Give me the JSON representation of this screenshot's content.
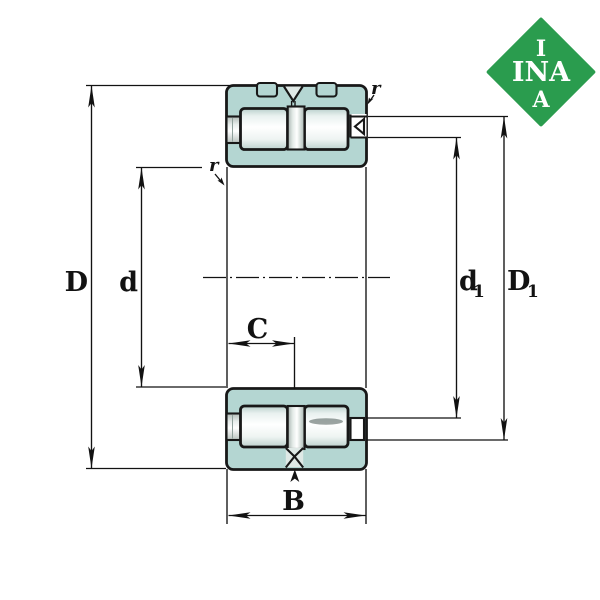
{
  "drawing": {
    "description": "Cross-section technical drawing of a double-row full-complement cylindrical roller bearing with dimension lines",
    "colors": {
      "ring_teal": "#b4d6d2",
      "roller_white": "#ffffff",
      "outline_dark": "#181818",
      "dimension_line": "#121212",
      "logo_green": "#2a9c4e",
      "logo_text": "#ffffff",
      "background": "#ffffff"
    },
    "logo": {
      "top": "I",
      "middle": "INA",
      "bottom": "A"
    },
    "dimensions": {
      "D": {
        "label": "D"
      },
      "d": {
        "label": "d"
      },
      "C": {
        "label": "C"
      },
      "B": {
        "label": "B"
      },
      "d1": {
        "base": "d",
        "sub": "1"
      },
      "D1": {
        "base": "D",
        "sub": "1"
      },
      "r_left": {
        "label": "r"
      },
      "r_right": {
        "label": "r"
      }
    }
  }
}
